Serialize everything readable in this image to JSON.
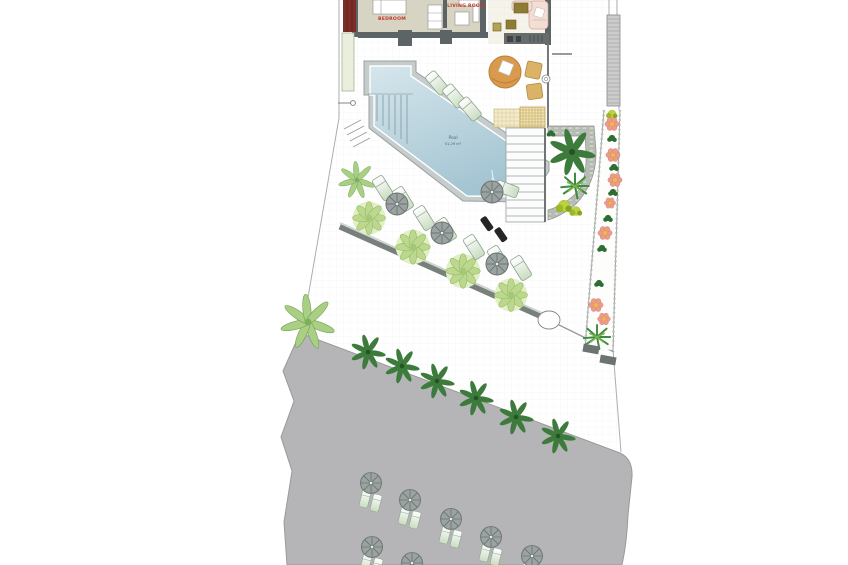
{
  "plan": {
    "labels": {
      "bedroom": "BEDROOM",
      "living_room": "LIVING ROOM",
      "pool_name": "Pool",
      "pool_area": "51,29 m²"
    },
    "colors": {
      "pool_water_deep": "#a3c4d2",
      "pool_water_light": "#d6e6ec",
      "beach_sand": "#b5b5b7",
      "label_red": "#c0392b",
      "wall_gray": "#5d6466",
      "maroon_strip": "#7b2d28",
      "vegetation_light": "#bcd88e",
      "vegetation_dark": "#3d7b3d",
      "flower_pink": "#eb9d8d",
      "wood_tan": "#d99a4e"
    }
  }
}
